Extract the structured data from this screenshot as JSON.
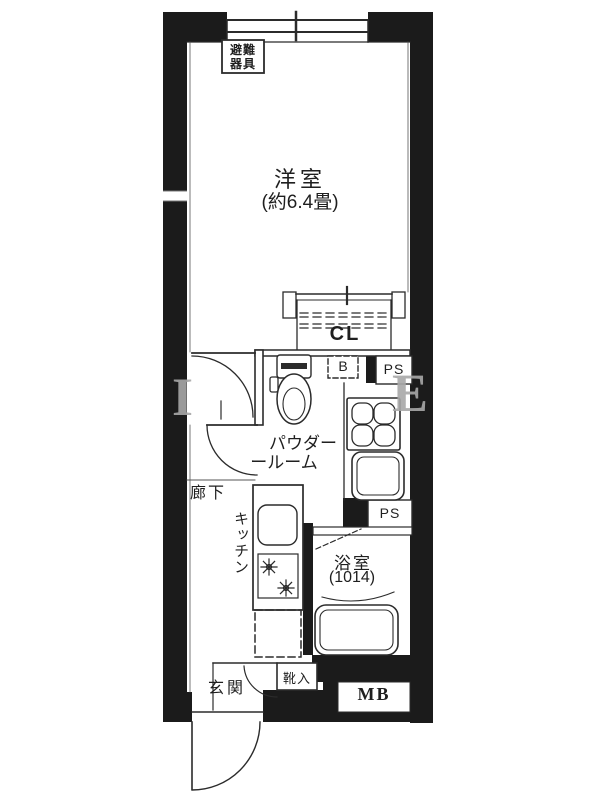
{
  "labels": {
    "evacuation_equipment_line1": "避難",
    "evacuation_equipment_line2": "器具",
    "main_room": "洋室",
    "main_room_size": "(約6.4畳)",
    "closet": "CL",
    "water_heater": "B",
    "pipe_space_upper": "PS",
    "pipe_space_lower": "PS",
    "powder_room_line1": "パウダー",
    "powder_room_line2": "ールーム",
    "corridor": "廊下",
    "kitchen": "キッチン",
    "bathroom": "浴室",
    "bathroom_size": "(1014)",
    "entrance": "玄関",
    "shoe_cabinet": "靴入",
    "meter_box": "MB"
  },
  "watermark": {
    "left_letter": "I",
    "right_letter": "E"
  },
  "colors": {
    "wall": "#1b1b1b",
    "line": "#2b2b2b",
    "background": "#ffffff",
    "watermark": "#a8a8a8"
  }
}
